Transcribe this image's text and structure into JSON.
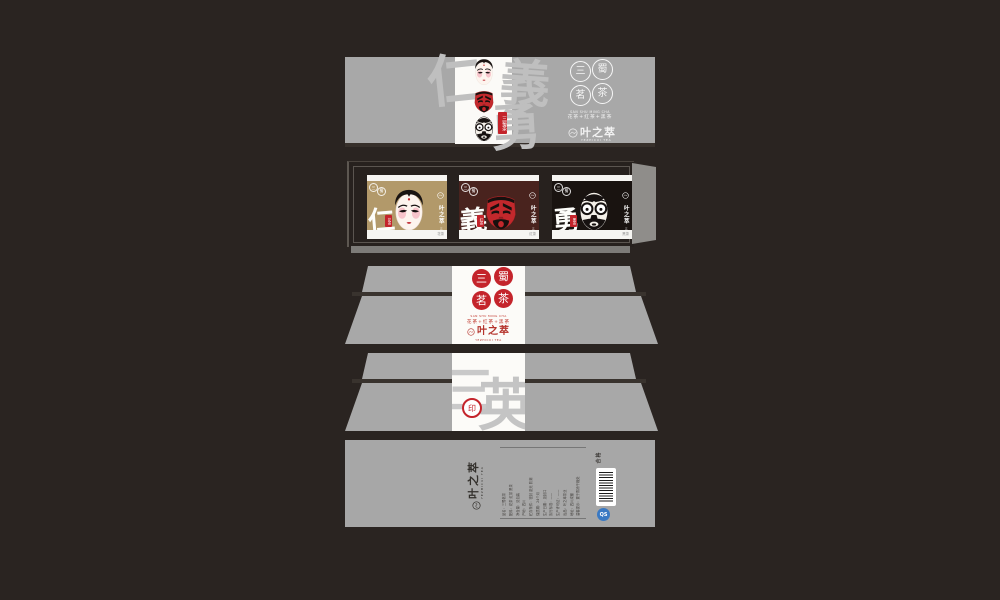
{
  "colors": {
    "page_background": "#2a2421",
    "panel_gray": "#a8a8a8",
    "strip_white": "#fbfaf7",
    "seal_red": "#c4242b",
    "card_gold": "#b2996a",
    "card_maroon": "#49231e",
    "card_black": "#191310",
    "tray_dark": "#27211e",
    "qs_blue": "#3a79c3"
  },
  "brand": {
    "logo_name": "叶之萃",
    "logo_sub": "YEZHICUI TEA",
    "seal_chars": [
      "三",
      "蜀",
      "茗",
      "茶"
    ],
    "series_latin": "SAN SHU MING CHA",
    "series_teas": "花茶+红茶+黑茶"
  },
  "sleeve": {
    "watermark_chars": [
      "仁",
      "義",
      "勇"
    ],
    "side_tag": "三蜀茶",
    "masks": [
      "dan-mask",
      "guan-red-mask",
      "zhang-black-mask"
    ]
  },
  "tray": {
    "corner_seal_chars": [
      "三",
      "蜀"
    ],
    "side_note": "三蜀茗茶",
    "cards": [
      {
        "virtue": "仁",
        "tea_seal": "花茶",
        "footer": "花茶",
        "mask": "dan-mask"
      },
      {
        "virtue": "義",
        "tea_seal": "红茶",
        "footer": "红茶",
        "mask": "guan-red-mask"
      },
      {
        "virtue": "勇",
        "tea_seal": "黑茶",
        "footer": "黑茶",
        "mask": "zhang-black-mask"
      }
    ]
  },
  "box_back": {
    "watermark_left": "三",
    "watermark_right": "英",
    "seal_char": "印"
  },
  "box_bottom": {
    "cert_label": "合格",
    "qs_label": "QS",
    "fineprint": [
      "品名：三蜀茗茶",
      "配料：花茶 红茶 黑茶",
      "净含量：见包装",
      "产地：四川",
      "贮存条件：密封 避光 防潮",
      "保质期：24个月",
      "生产日期：见封口",
      "执行标准：——",
      "生产许可证：——",
      "出品：叶之萃茶业",
      "地址：四川成都",
      "温馨提示：置于阴凉干燥处"
    ]
  }
}
